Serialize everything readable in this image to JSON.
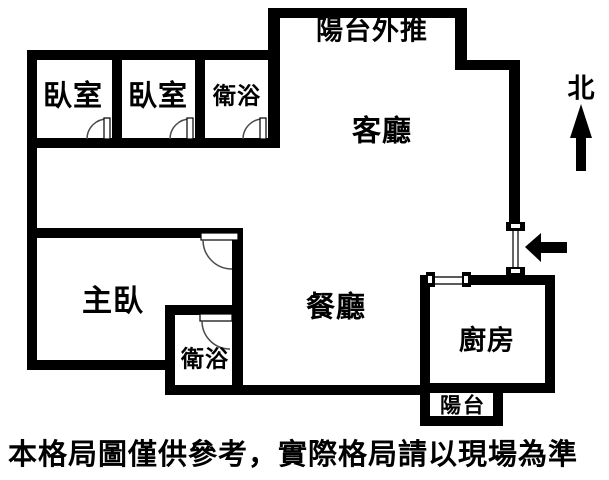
{
  "rooms": {
    "balcony_pushed": "陽台外推",
    "bedroom1": "臥室",
    "bedroom2": "臥室",
    "bathroom1": "衛浴",
    "living_room": "客廳",
    "master_bedroom": "主臥",
    "dining_room": "餐廳",
    "bathroom2": "衛浴",
    "kitchen": "廚房",
    "balcony": "陽台"
  },
  "compass": {
    "north_label": "北"
  },
  "disclaimer": "本格局圖僅供參考，實際格局請以現場為準",
  "colors": {
    "wall": "#000000",
    "background": "#ffffff",
    "door_line": "#4a4a4a"
  }
}
